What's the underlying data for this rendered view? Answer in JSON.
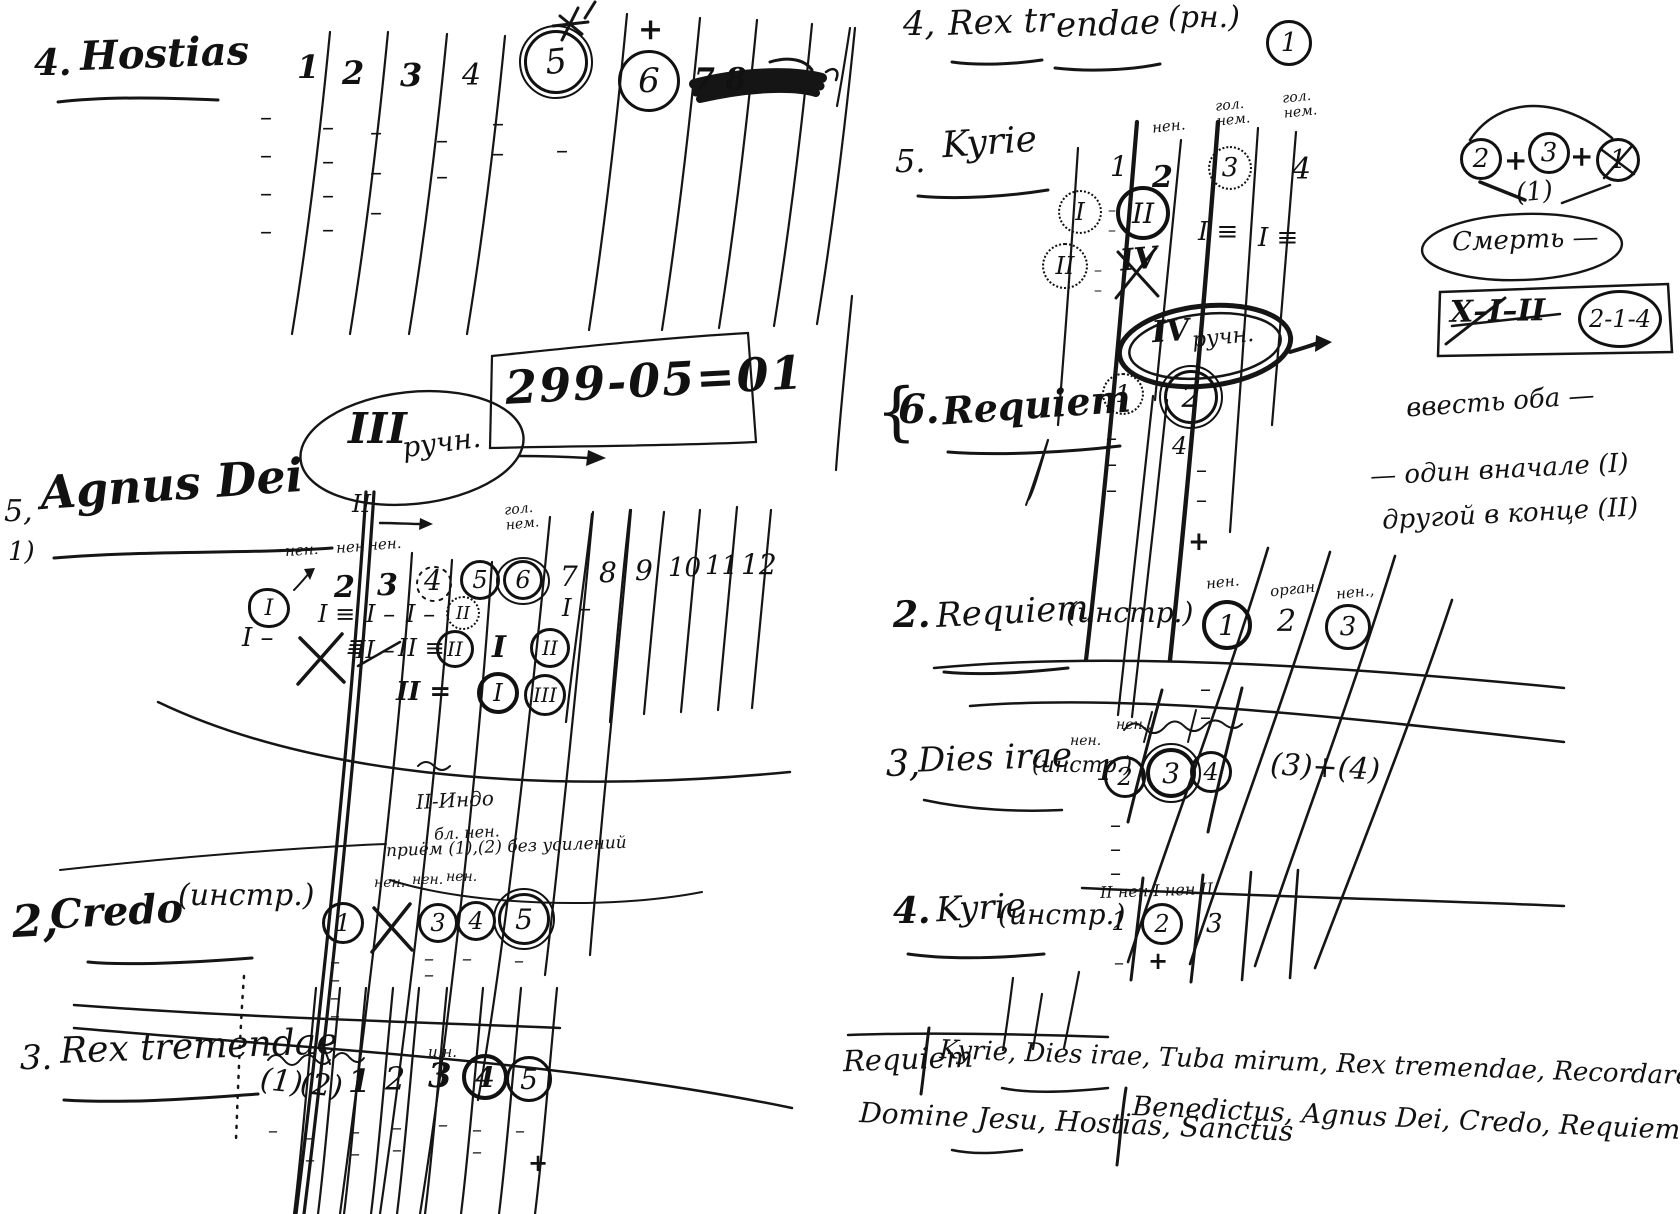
{
  "colors": {
    "ink": "#111111",
    "paper": "#ffffff"
  },
  "left": {
    "hostias": {
      "num": "4.",
      "title": "Hostias",
      "c1": "1",
      "c2": "2",
      "c3": "3",
      "c4": "4",
      "c5": "5",
      "c6": "6",
      "plus6": "+",
      "crossed": "7  8",
      "d1": "–\n–\n–\n–",
      "d2": "–\n–\n–\n–",
      "d3": "–\n–\n–",
      "d4": "–\n–",
      "d5": "–\n–",
      "d6": "–"
    },
    "date": "299-05=01",
    "oval3": {
      "roman": "III",
      "word": "ручн."
    },
    "mark_II": "II",
    "agnus": {
      "num_top": "5,",
      "num_bot": "1)",
      "title": "Agnus Dei",
      "lab1": "нен.",
      "lab2": "нен",
      "lab3": "нен.",
      "lab6": "гол.\nнем.",
      "c2": "2",
      "c3": "3",
      "c4": "4",
      "c5": "5",
      "c6": "6",
      "c7": "7",
      "c8": "8",
      "c9": "9",
      "c10": "10",
      "c11": "11",
      "c12": "12",
      "bubble": "I",
      "bubble_mark": "I –",
      "m2a": "I ≡",
      "m2x": "≣",
      "m3a": "I –",
      "m3b": "II –",
      "m4a": "I –",
      "m4b": "II ≡",
      "m4c": "II =",
      "m45a": "II",
      "m45b": "II",
      "m5": "I",
      "m56": "II",
      "m56b": "I",
      "m6": "III",
      "m7": "I –"
    },
    "note_mid": {
      "l1": "II-Индо",
      "l2": "бл. нен."
    },
    "priem": "приём (1),(2) без усилений",
    "credo": {
      "num": "2,",
      "title": "Credo",
      "paren": "(инстр.)",
      "lab1": "нен.",
      "lab2": "нен.",
      "lab3": "нен.",
      "i1": "1",
      "i3": "3",
      "i4": "4",
      "i5": "5",
      "d1": "–\n–\n–\n–",
      "d3": "–\n–",
      "d4": "–",
      "d5": "–"
    },
    "rex": {
      "num": "3.",
      "title": "Rex tremendae",
      "lab": "и.н.",
      "i1": "(1)",
      "i2": "(2)",
      "i3": "1",
      "i4": "2",
      "i5": "3",
      "i6": "4",
      "i7": "5",
      "d1": "–",
      "d2": "–\n–",
      "d3": "–\n–",
      "d4": "–\n–",
      "d5": "–",
      "d6": "–\n–",
      "d7": "–",
      "plus": "+"
    }
  },
  "right": {
    "rex4": {
      "num": "4,",
      "t1": "Rex tr",
      "t2": "endae",
      "paren": "(рн.)",
      "badge": "1"
    },
    "kyrie5": {
      "num": "5.",
      "title": "Kyrie",
      "lab2": "нен.",
      "lab3": "гол.\nнем.",
      "lab4": "гол.\nнем.",
      "c1": "1",
      "c2": "2",
      "c3": "3",
      "c4": "4",
      "mI": "I",
      "mI_d": "–\n–",
      "mII": "II",
      "mII_d": "–\n–",
      "mII2": "II",
      "mIV": "IV",
      "m3": "I ≡",
      "m4": "I ≡"
    },
    "req6": {
      "brace": "{",
      "num": "6.",
      "title": "Requiem",
      "i1": "1",
      "ovalR": "IV",
      "ovalW": "ручн.",
      "i2": "2",
      "mark": "4·",
      "d1": "–\n–\n–",
      "d2": "–\n–",
      "plus": "+"
    },
    "sum": {
      "a": "2",
      "p1": "+",
      "b": "3",
      "p2": "+",
      "c": "1",
      "below": "(1)"
    },
    "death": "Смерть —",
    "box": {
      "seq": "X–I–II",
      "circle": "2-1-4"
    },
    "note": {
      "l1": "ввесть оба —",
      "l2": "— один вначале (I)",
      "l3": "другой в конце (II)"
    },
    "req2": {
      "num": "2.",
      "title": "Requiem",
      "paren": "(инстр.)",
      "lab1": "нен.",
      "lab2": "орган",
      "lab3": "нен.,",
      "i1": "1",
      "i2": "2",
      "i3": "3",
      "d1": "–\n–"
    },
    "dies3": {
      "num": "3,",
      "title": "Dies irae",
      "paren": "(инстр.)",
      "after": "1",
      "lab1": "нен.",
      "lab2": "нен.,",
      "i2": "2",
      "i3": "3",
      "i4": "4",
      "extra": "(3)+(4)",
      "d2": "–\n–\n–"
    },
    "kyrie4": {
      "num": "4.",
      "title": "Kyrie",
      "paren": "(инстр.)",
      "header": "II нен I нен II",
      "i1": "1",
      "i2": "2",
      "i3": "3",
      "plus": "+",
      "d1": "–"
    },
    "footer": {
      "l1a": "Requiem",
      "l1b": "Kyrie, Dies irae, Tuba mirum, Rex tremendae, Recordare, Lacrimosa",
      "l2a": "Domine Jesu, Hostias, Sanctus",
      "l2b": "Benedictus, Agnus Dei, Credo, Requiem"
    }
  }
}
